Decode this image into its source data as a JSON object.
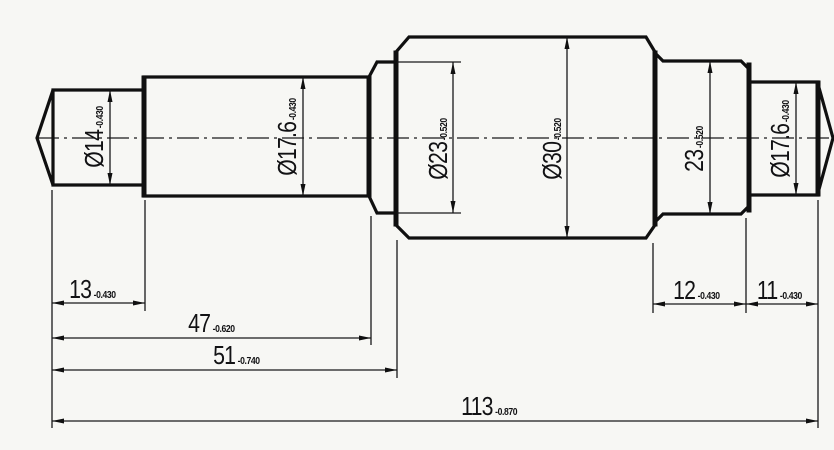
{
  "drawing": {
    "diameter_labels": [
      {
        "value": "Ø14",
        "tol": "-0.430"
      },
      {
        "value": "Ø17.6",
        "tol": "-0.430"
      },
      {
        "value": "Ø23",
        "tol": "-0.520"
      },
      {
        "value": "Ø30",
        "tol": "-0.520"
      },
      {
        "value": "23",
        "tol": "-0.520"
      },
      {
        "value": "Ø17.6",
        "tol": "-0.430"
      }
    ],
    "length_labels": [
      {
        "value": "13",
        "tol": "-0.430"
      },
      {
        "value": "47",
        "tol": "-0.620"
      },
      {
        "value": "51",
        "tol": "-0.740"
      },
      {
        "value": "113",
        "tol": "-0.870"
      },
      {
        "value": "12",
        "tol": "-0.430"
      },
      {
        "value": "11",
        "tol": "-0.430"
      }
    ],
    "line_color": "#101010",
    "background_color": "#f7f7f4"
  }
}
